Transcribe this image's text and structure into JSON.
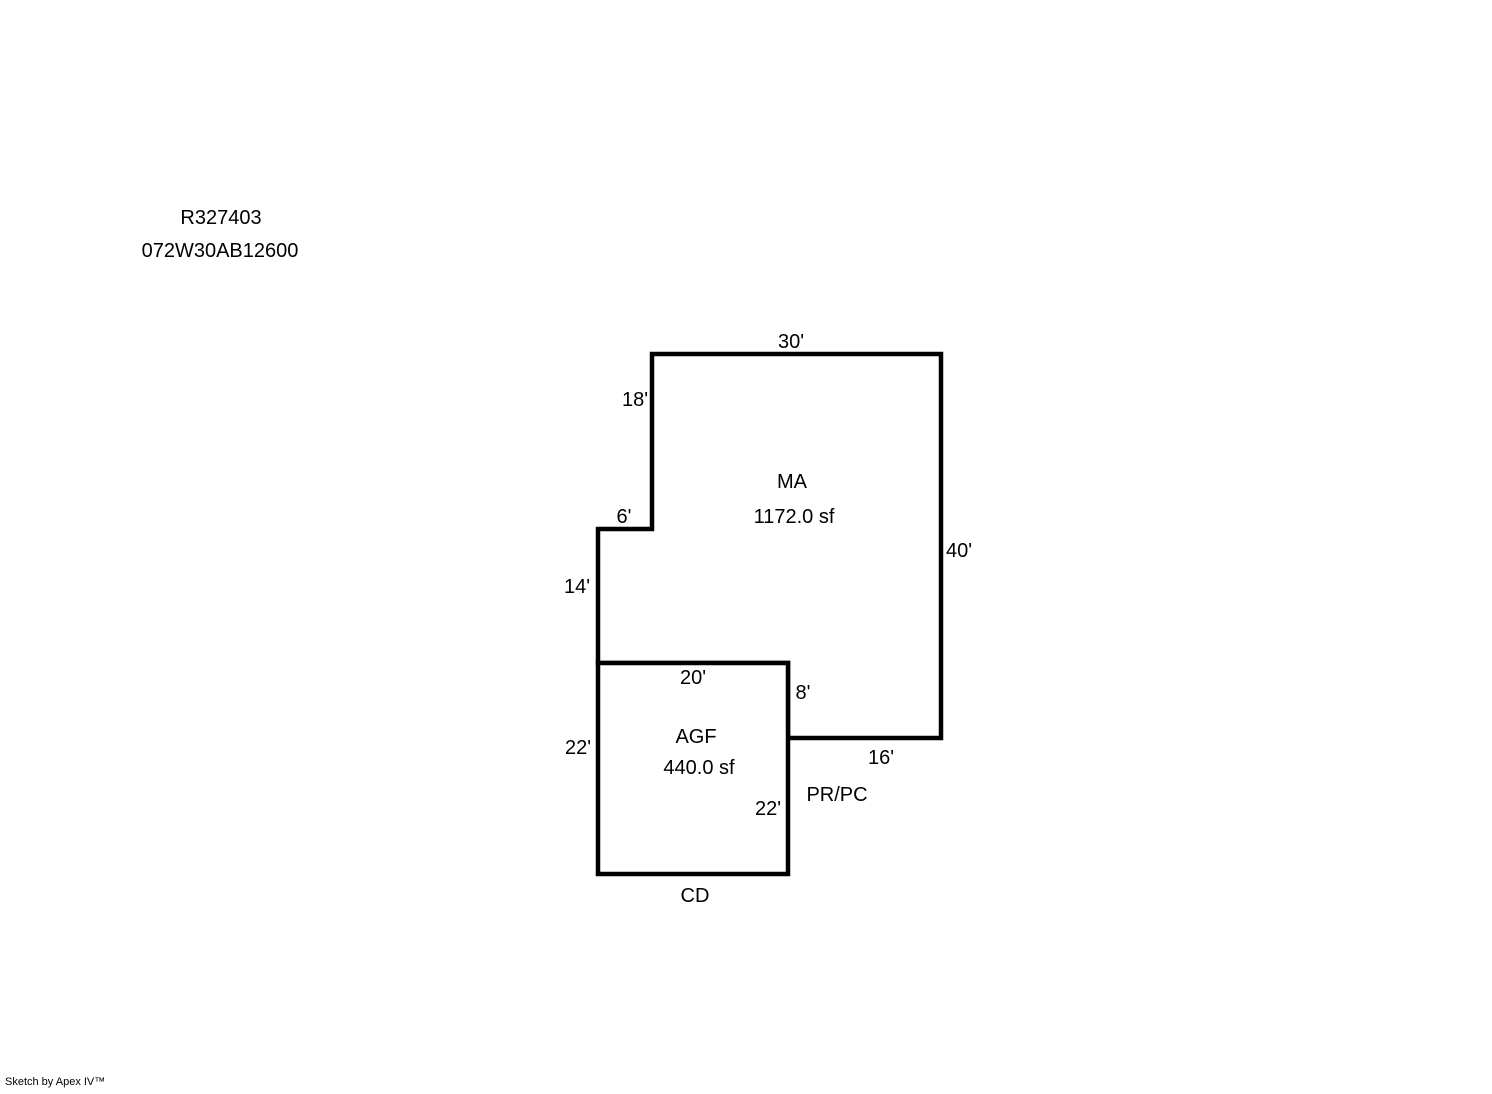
{
  "header": {
    "record_id": "R327403",
    "parcel_id": "072W30AB12600"
  },
  "floorplan": {
    "areas": {
      "ma": {
        "name": "MA",
        "size": "1172.0 sf"
      },
      "agf": {
        "name": "AGF",
        "size": "440.0 sf"
      }
    },
    "dimensions": {
      "ma_top": "30'",
      "ma_left_upper": "18'",
      "ma_step": "6'",
      "ma_left_lower": "14'",
      "ma_right": "40'",
      "ma_bottom": "16'",
      "ma_inner_vertical": "8'",
      "agf_top": "20'",
      "agf_left": "22'",
      "agf_right": "22'"
    },
    "annotations": {
      "pr_pc": "PR/PC",
      "cd": "CD"
    },
    "line_color": "#000000"
  },
  "footer": {
    "credit": "Sketch by Apex IV™"
  }
}
